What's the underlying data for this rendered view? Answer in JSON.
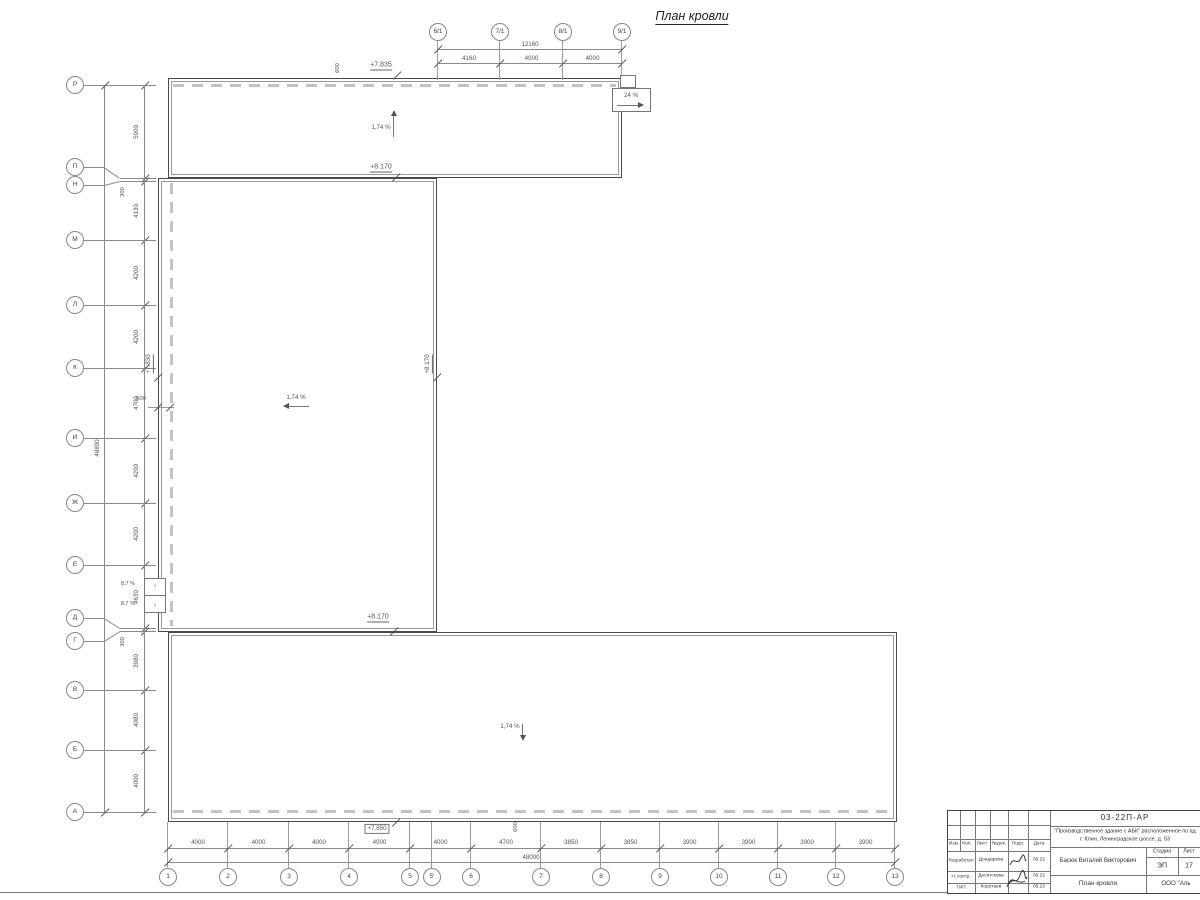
{
  "title": "План кровли",
  "axes": {
    "left": {
      "labels": [
        "Р",
        "П",
        "Н",
        "М",
        "Л",
        "К",
        "И",
        "Ж",
        "Е",
        "Д",
        "Г",
        "В",
        "Б",
        "А"
      ],
      "dims": [
        "5900",
        "300",
        "4130",
        "4200",
        "4200",
        "4700",
        "4200",
        "4200",
        "4630",
        "300",
        "3980",
        "4080",
        "4000"
      ],
      "total": "48800"
    },
    "bottom": {
      "labels": [
        "1",
        "2",
        "3",
        "4",
        "5",
        "5'",
        "6",
        "7",
        "8",
        "9",
        "10",
        "11",
        "12",
        "13"
      ],
      "dims": [
        "4000",
        "4000",
        "4000",
        "4000",
        "4000",
        "4700",
        "3850",
        "3850",
        "3900",
        "3900",
        "3900",
        "3900"
      ],
      "total": "48000"
    },
    "top": {
      "labels": [
        "6/1",
        "7/1",
        "8/1",
        "9/1"
      ],
      "dims": [
        "4160",
        "4000",
        "4000"
      ],
      "total": "12160"
    }
  },
  "annotations": {
    "elev_top": "+7.835",
    "elev_top_inner": "+8.170",
    "elev_mid_left": "+7.830",
    "elev_mid_right": "+8.170",
    "elev_mid_bottom": "+8.170",
    "elev_bottom": "+7.850",
    "slope_top": "1,74 %",
    "slope_mid": "1,74 %",
    "slope_bottom": "1,74 %",
    "slope_ramp": "24 %",
    "slope_stair_up": "8,7 %",
    "slope_stair_down": "8,7 %",
    "dim_600_top": "600",
    "dim_600_left": "600",
    "dim_600_bottom": "600"
  },
  "titleblock": {
    "doc_number": "03-22П-АР",
    "project_line1": "\"Производственное здание с АБК\" расположенное по ад",
    "project_line2": "г. Клин, Ленинградское шоссе, д. 53",
    "cols": [
      "Изм.",
      "Кол.",
      "Лист",
      "№док.",
      "Подп.",
      "Дата"
    ],
    "rows": [
      {
        "role": "Разработал",
        "name": "Дондарева",
        "date": "05.22"
      },
      {
        "role": "Н. контр.",
        "name": "Десятскова",
        "date": "05.22"
      },
      {
        "role": "ГИП",
        "name": "Коротаев",
        "date": "05.22"
      }
    ],
    "stage_label": "Стадия",
    "sheet_label": "Лист",
    "stage": "ЭП",
    "sheet": "17",
    "author": "Басюк Виталий Викторович",
    "drawing_name": "План кровли",
    "company": "ООО \"Аль"
  }
}
